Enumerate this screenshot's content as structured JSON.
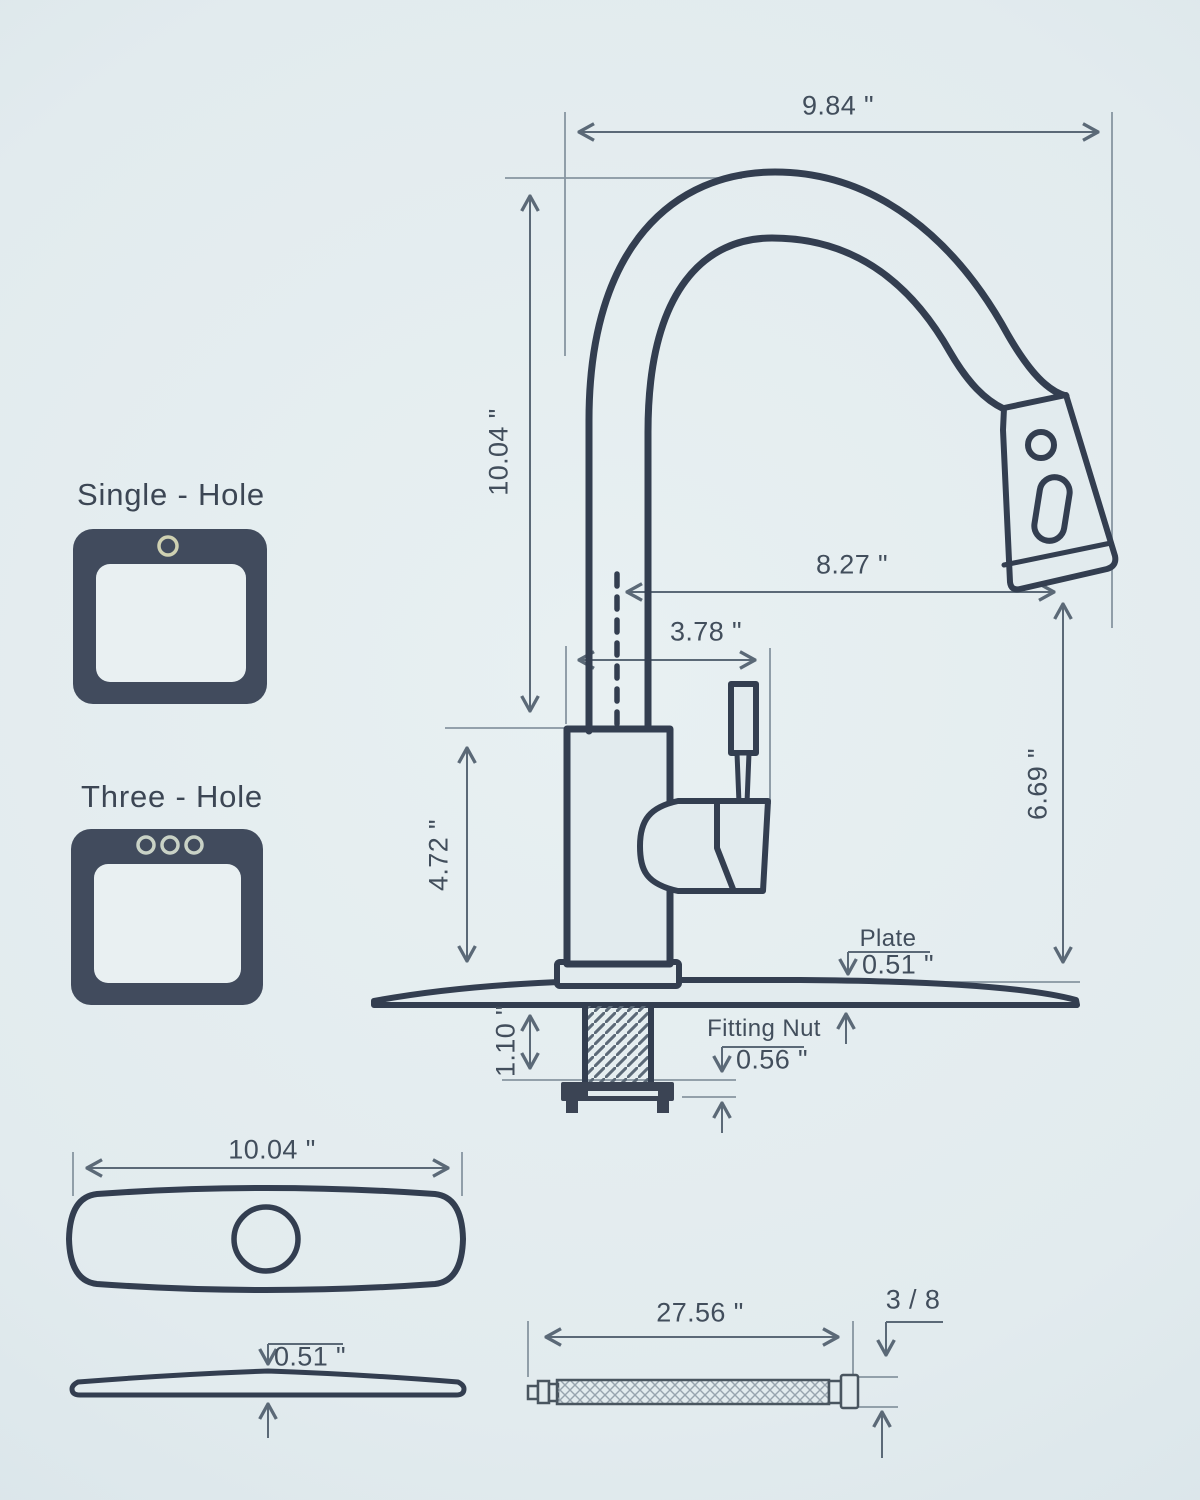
{
  "colors": {
    "background": "#e2ebee",
    "ink": "#333e50",
    "dimension_lines": "#5b6977",
    "icon_fill": "#414b5d",
    "single_hole_ring": "#cfd1b2",
    "three_hole_ring": "#c9d2c6"
  },
  "mount_options": {
    "single": "Single - Hole",
    "three": "Three - Hole"
  },
  "dimensions": {
    "spout_reach_top": "9.84 \"",
    "spout_height": "10.04 \"",
    "outlet_reach": "8.27 \"",
    "neck_offset": "3.78 \"",
    "body_height": "4.72 \"",
    "outlet_clearance": "6.69 \"",
    "plate_label": "Plate",
    "plate_thickness": "0.51 \"",
    "counter_thickness": "1.10 \"",
    "fitting_nut_label": "Fitting Nut",
    "fitting_nut_height": "0.56 \"",
    "plate_width": "10.04 \"",
    "plate_side_thickness": "0.51 \"",
    "hose_length": "27.56 \"",
    "hose_connector": "3 / 8"
  }
}
